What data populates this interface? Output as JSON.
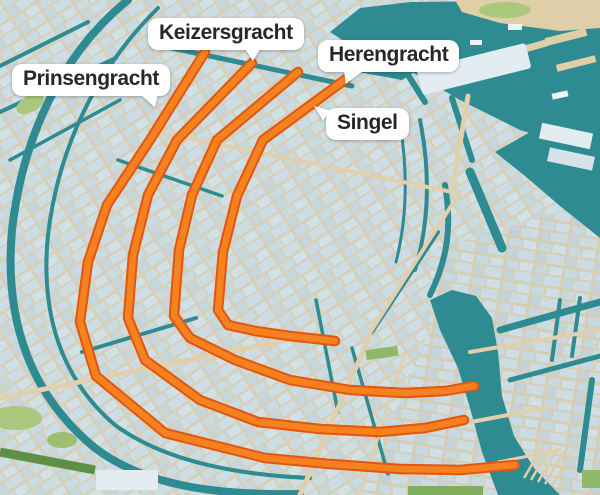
{
  "figure": {
    "kind": "3d-city-map-infographic",
    "highlighted_feature": "canal ring"
  },
  "labels": {
    "prinsengracht": "Prinsengracht",
    "keizersgracht": "Keizersgracht",
    "herengracht": "Herengracht",
    "singel": "Singel"
  },
  "colors": {
    "water": "#2e8b92",
    "land": "#d9e4ea",
    "building_light": "#cfe0e8",
    "building_mid": "#c2d5de",
    "street": "#d8cdb0",
    "quay": "#decfa9",
    "canal_fill": "#f5821f",
    "canal_border": "#e25610",
    "park_light": "#a9c87d",
    "park_dark": "#5e8f47",
    "label_bg": "#ffffff",
    "label_text": "#272727",
    "big_building": "#e3ecf1"
  }
}
